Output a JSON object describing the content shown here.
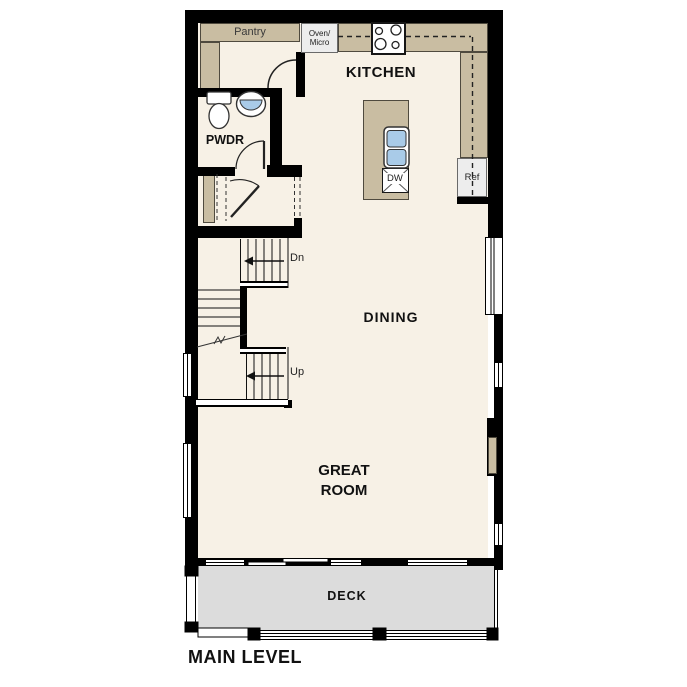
{
  "plan": {
    "title": "MAIN LEVEL",
    "rooms": {
      "kitchen": "KITCHEN",
      "dining": "DINING",
      "great_room": "GREAT ROOM",
      "powder": "PWDR",
      "pantry": "Pantry",
      "deck": "DECK"
    },
    "labels": {
      "oven_micro_line1": "Oven/",
      "oven_micro_line2": "Micro",
      "dishwasher": "DW",
      "refrigerator": "Ref",
      "stairs_down": "Dn",
      "stairs_up": "Up"
    },
    "colors": {
      "wall": "#000000",
      "floor": "#f7f1e6",
      "counter_tan": "#c9bda2",
      "deck_gray": "#dcdcdc",
      "sink_blue": "#a9cbe8",
      "appliance_gray": "#ededed"
    }
  }
}
